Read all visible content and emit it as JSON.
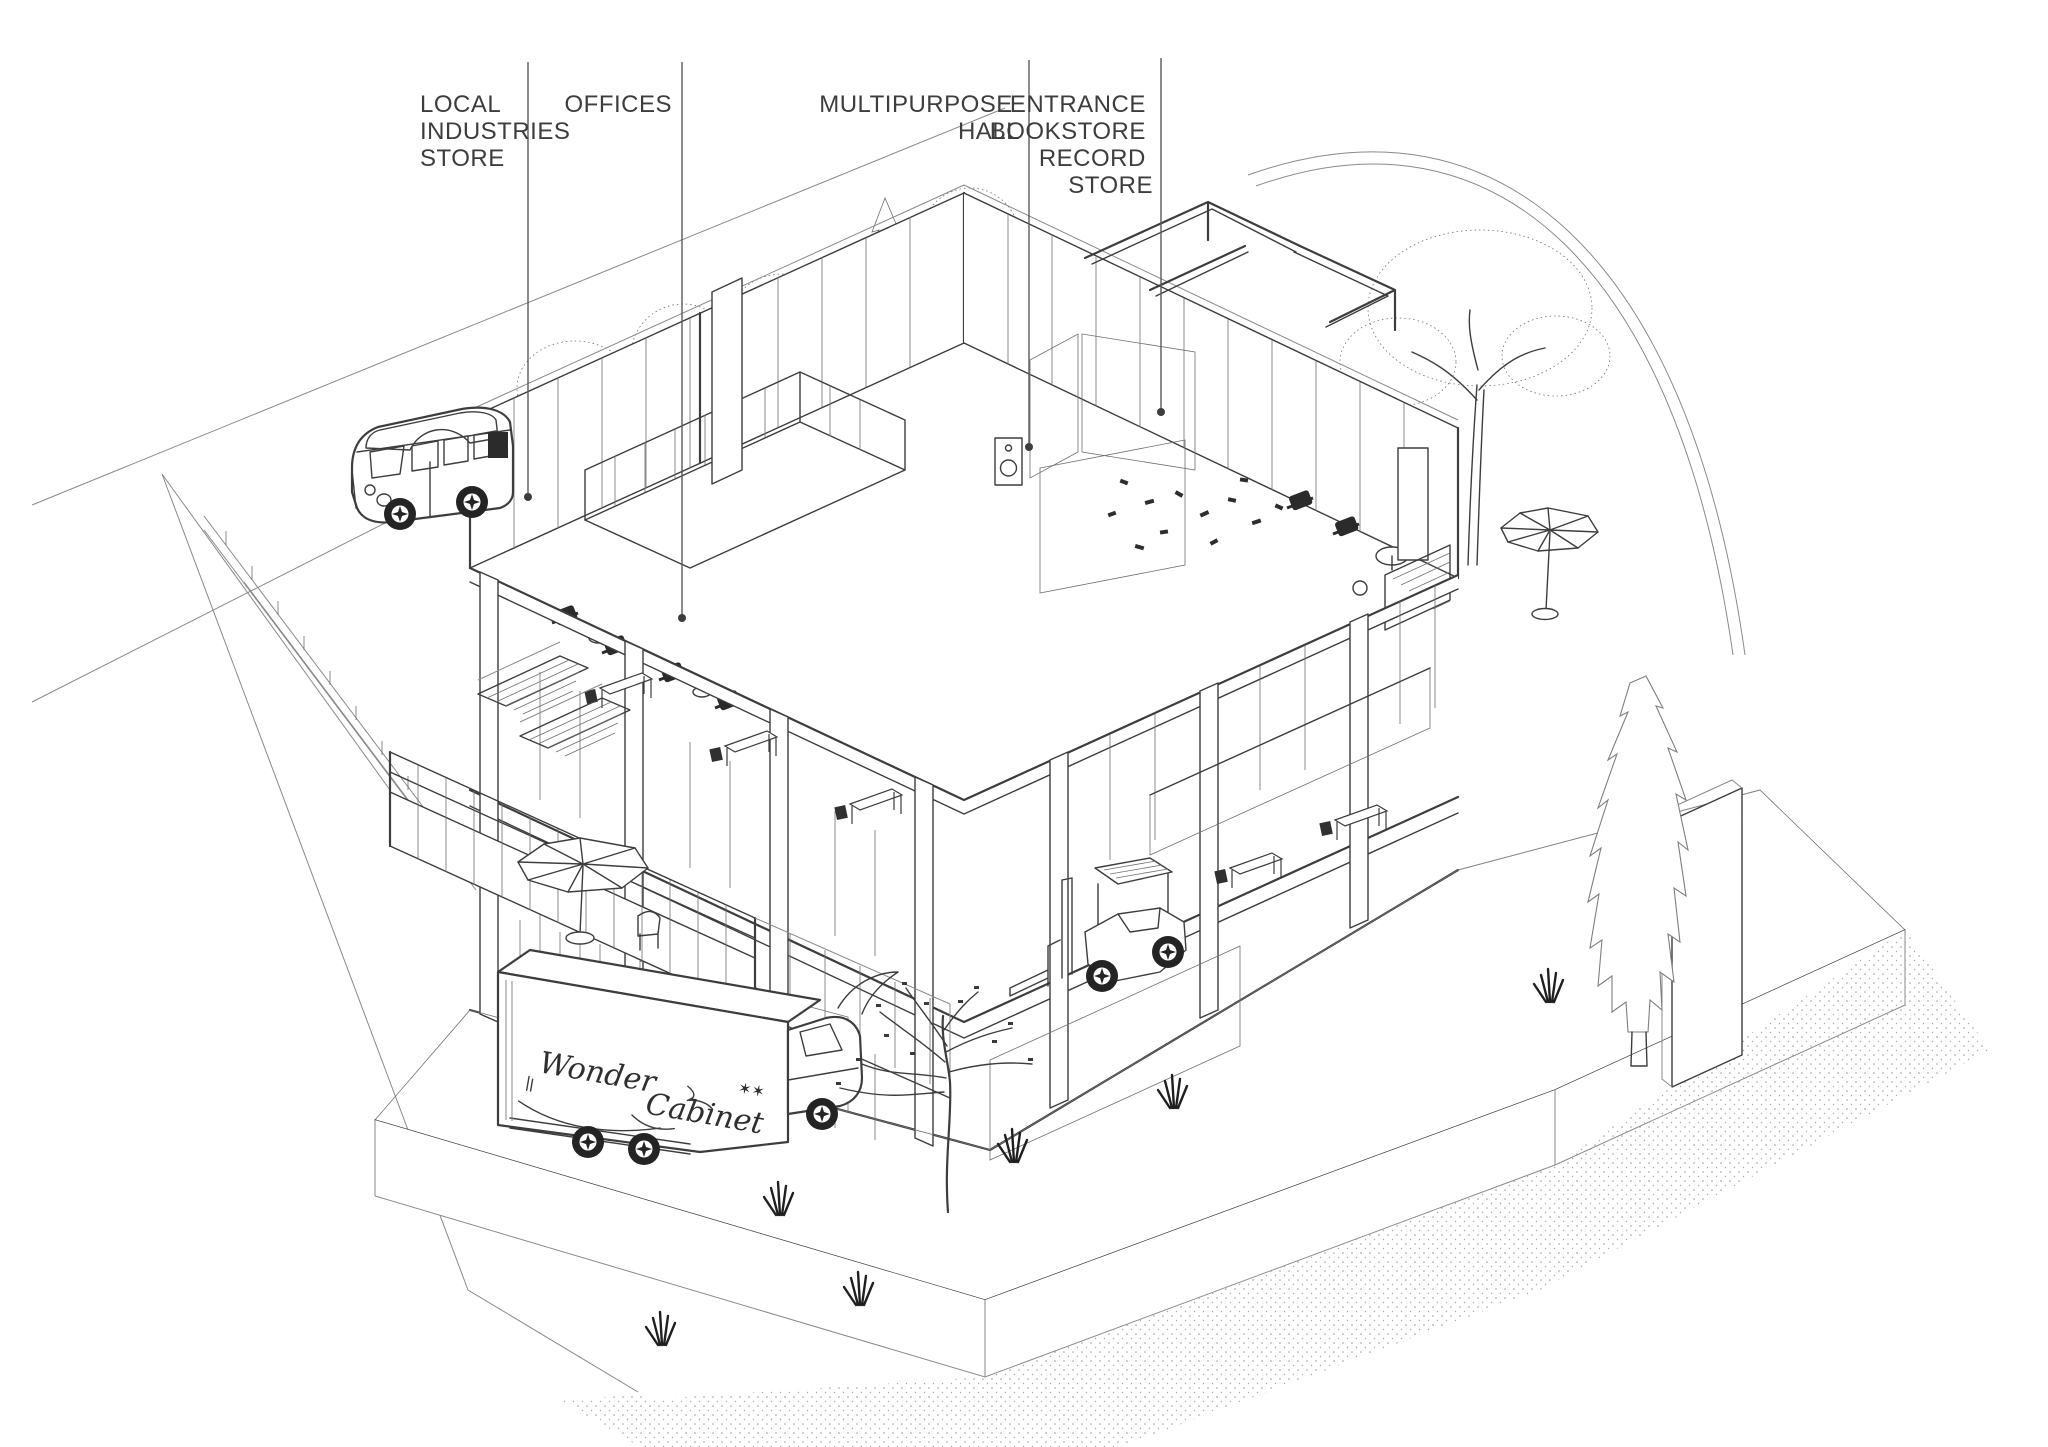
{
  "scene": {
    "background": "#ffffff",
    "ink": "#3d3d3d",
    "light_ink": "#8a8a8a"
  },
  "labels": [
    {
      "id": "local-industries-store",
      "lines": [
        "LOCAL",
        "INDUSTRIES",
        "STORE"
      ]
    },
    {
      "id": "offices",
      "lines": [
        "OFFICES"
      ]
    },
    {
      "id": "multipurpose-hall",
      "lines": [
        "MULTIPURPOSE",
        "HALL"
      ]
    },
    {
      "id": "entrance-bookstore-record-store",
      "lines": [
        "ENTRANCE",
        "BOOKSTORE",
        "RECORD",
        "STORE"
      ]
    }
  ],
  "truck": {
    "brand_words": [
      "Wonder",
      "Cabinet"
    ],
    "stars": "✶✶"
  }
}
